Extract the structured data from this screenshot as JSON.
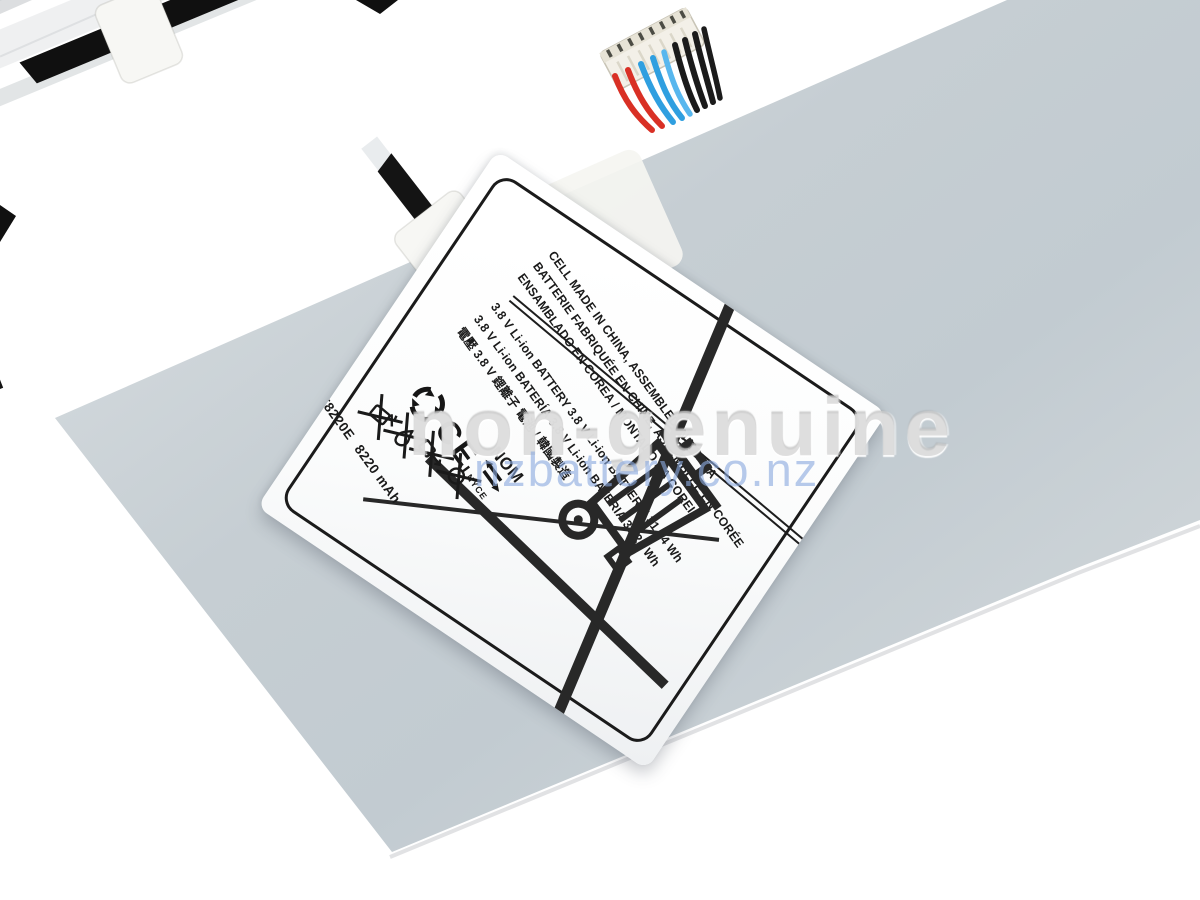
{
  "photo": {
    "subject": "tablet-battery-product-photo",
    "background_color": "#ffffff",
    "body_color": "#c9d1d6",
    "rail_color": "#151515",
    "tape_color": "#f7f7f4",
    "band_color": "#f1efe4",
    "wire_colors": {
      "red": "#d93025",
      "blue": "#2f9fe0",
      "black": "#1b1b1b"
    }
  },
  "watermark": {
    "brand_overlay": "non-genuine",
    "site_url": "nzbattery.co.nz",
    "overlay_color": "#c5c5c5",
    "url_color": "#8baadf"
  },
  "label": {
    "origin_lines": [
      "CELL MADE IN CHINA, ASSEMBLED IN KOREA",
      "BATTERIE FABRIQUÉE EN CHINE, ASSEMBLÉE EN CORÉE",
      "ENSAMBLADO EN COREA / MONTADO NA COREIA"
    ],
    "spec_lines": [
      "3.8 V Li-ion BATTERY 3.8 V Li-ion BATTERIE 31.24 Wh",
      "3.8 V Li-ion BATERÍA 3.8 V Li-ion BATERIA  31.24 Wh",
      "電壓 3.8 V 鋰離子 電池 / 韓國製造"
    ],
    "model": "T8220E",
    "capacity": "8220 mAh",
    "marks": {
      "ce": "CE",
      "nom": "NOM",
      "nyce": "NYCE"
    }
  }
}
